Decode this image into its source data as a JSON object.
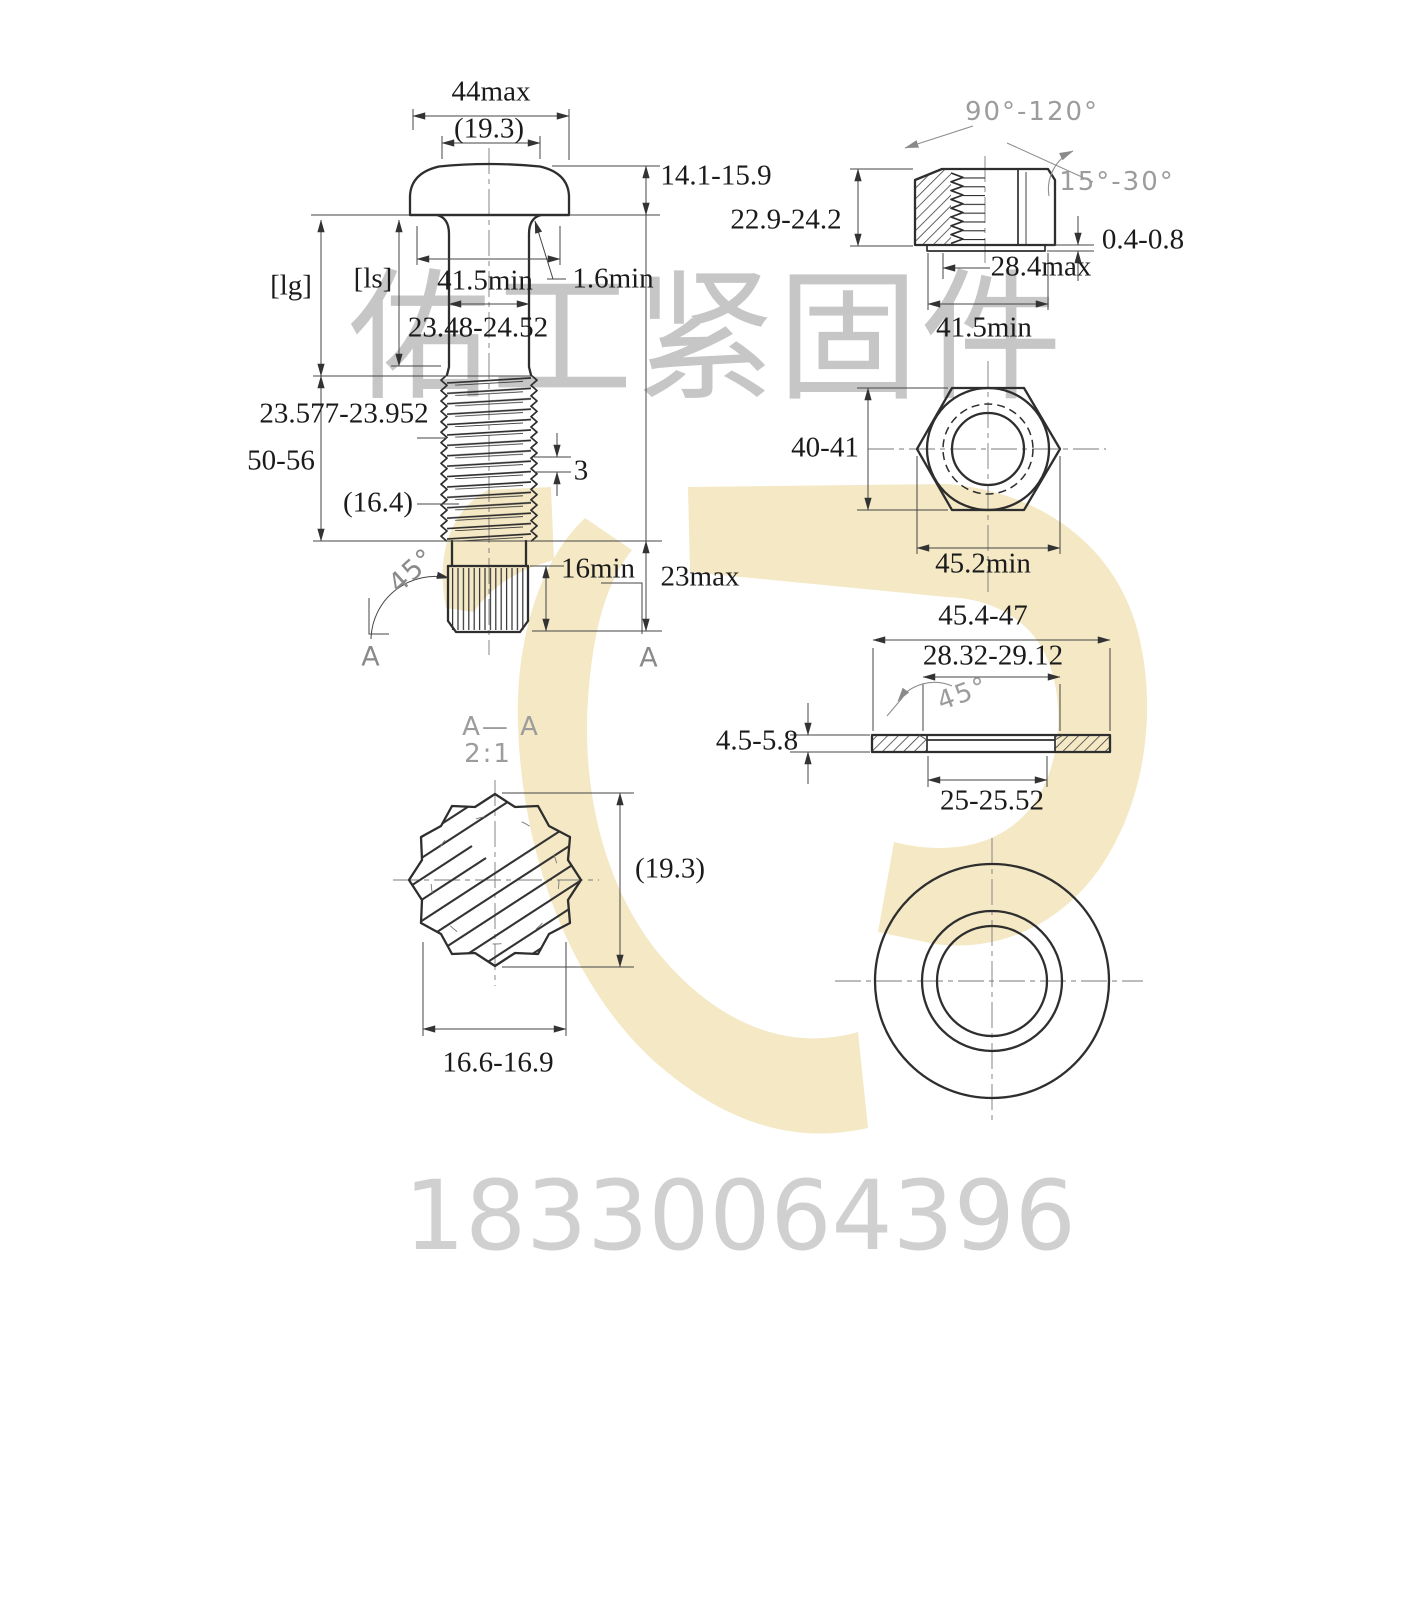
{
  "watermark": {
    "company_text": "佑工紧固件",
    "phone": "18330064396",
    "logo_color": "#f4e8c5",
    "company_color": "#c6c6c6",
    "phone_color": "#d0d0d0"
  },
  "colors": {
    "object_line": "#2e2e2e",
    "dim_line": "#454545",
    "dim_text": "#1b1b1b",
    "cad_gray_text": "#9c9c9c"
  },
  "bolt_view": {
    "head_dia": "44max",
    "head_ref_dia": "(19.3)",
    "head_height": "14.1-15.9",
    "grip_len_label": "[lg]",
    "shank_len_label": "[ls]",
    "bearing_dia": "41.5min",
    "fillet_radius": "1.6min",
    "shank_dia": "23.48-24.52",
    "thread_dia": "23.577-23.952",
    "thread_len": "50-56",
    "runout_ref": "(16.4)",
    "thread_pitch": "3",
    "chamfer_angle": "45°",
    "spline_len": "16min",
    "end_len": "23max",
    "section_mark_left": "A",
    "section_mark_right": "A"
  },
  "nut_view": {
    "crest_angle": "90°-120°",
    "chamfer_angle": "15°-30°",
    "height": "22.9-24.2",
    "washer_face_height": "0.4-0.8",
    "washer_face_dia": "28.4max",
    "bearing_dia": "41.5min",
    "across_flats": "40-41",
    "across_corners": "45.2min"
  },
  "washer_view": {
    "outer_dia": "45.4-47",
    "recess_dia": "28.32-29.12",
    "chamfer_angle": "45°",
    "thickness": "4.5-5.8",
    "hole_dia": "25-25.52"
  },
  "section_view": {
    "label": "A— A",
    "scale": "2:1",
    "dia_ref": "(19.3)",
    "spline_dia": "16.6-16.9"
  }
}
